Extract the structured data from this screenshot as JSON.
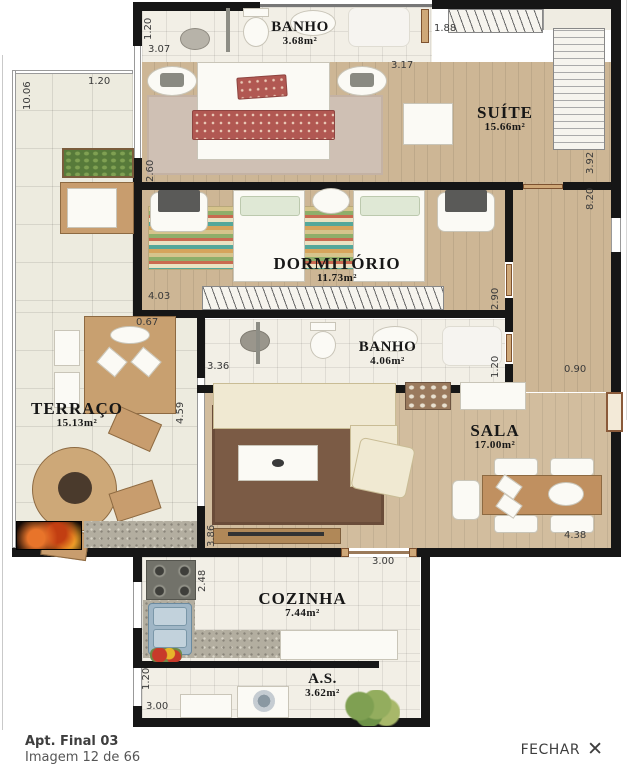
{
  "plan": {
    "rooms": {
      "banho_suite": {
        "name": "BANHO",
        "area": "3.68m²"
      },
      "suite": {
        "name": "SUÍTE",
        "area": "15.66m²"
      },
      "dormitorio": {
        "name": "DORMITÓRIO",
        "area": "11.73m²"
      },
      "banho_social": {
        "name": "BANHO",
        "area": "4.06m²"
      },
      "terraco": {
        "name": "TERRAÇO",
        "area": "15.13m²"
      },
      "sala": {
        "name": "SALA",
        "area": "17.00m²"
      },
      "cozinha": {
        "name": "COZINHA",
        "area": "7.44m²"
      },
      "area_servico": {
        "name": "A.S.",
        "area": "3.62m²"
      }
    },
    "measurements": [
      "1.20",
      "3.07",
      "1.88",
      "3.17",
      "1.20",
      "10.06",
      "2.60",
      "3.92",
      "8.20",
      "4.03",
      "2.90",
      "0.67",
      "3.36",
      "1.20",
      "0.90",
      "4.59",
      "3.86",
      "4.38",
      "3.00",
      "2.48",
      "1.20",
      "3.00"
    ]
  },
  "footer": {
    "apartment_label": "Apt. Final 03",
    "image_counter": "Imagem 12 de 66",
    "close_label": "FECHAR",
    "close_icon": "✕"
  }
}
